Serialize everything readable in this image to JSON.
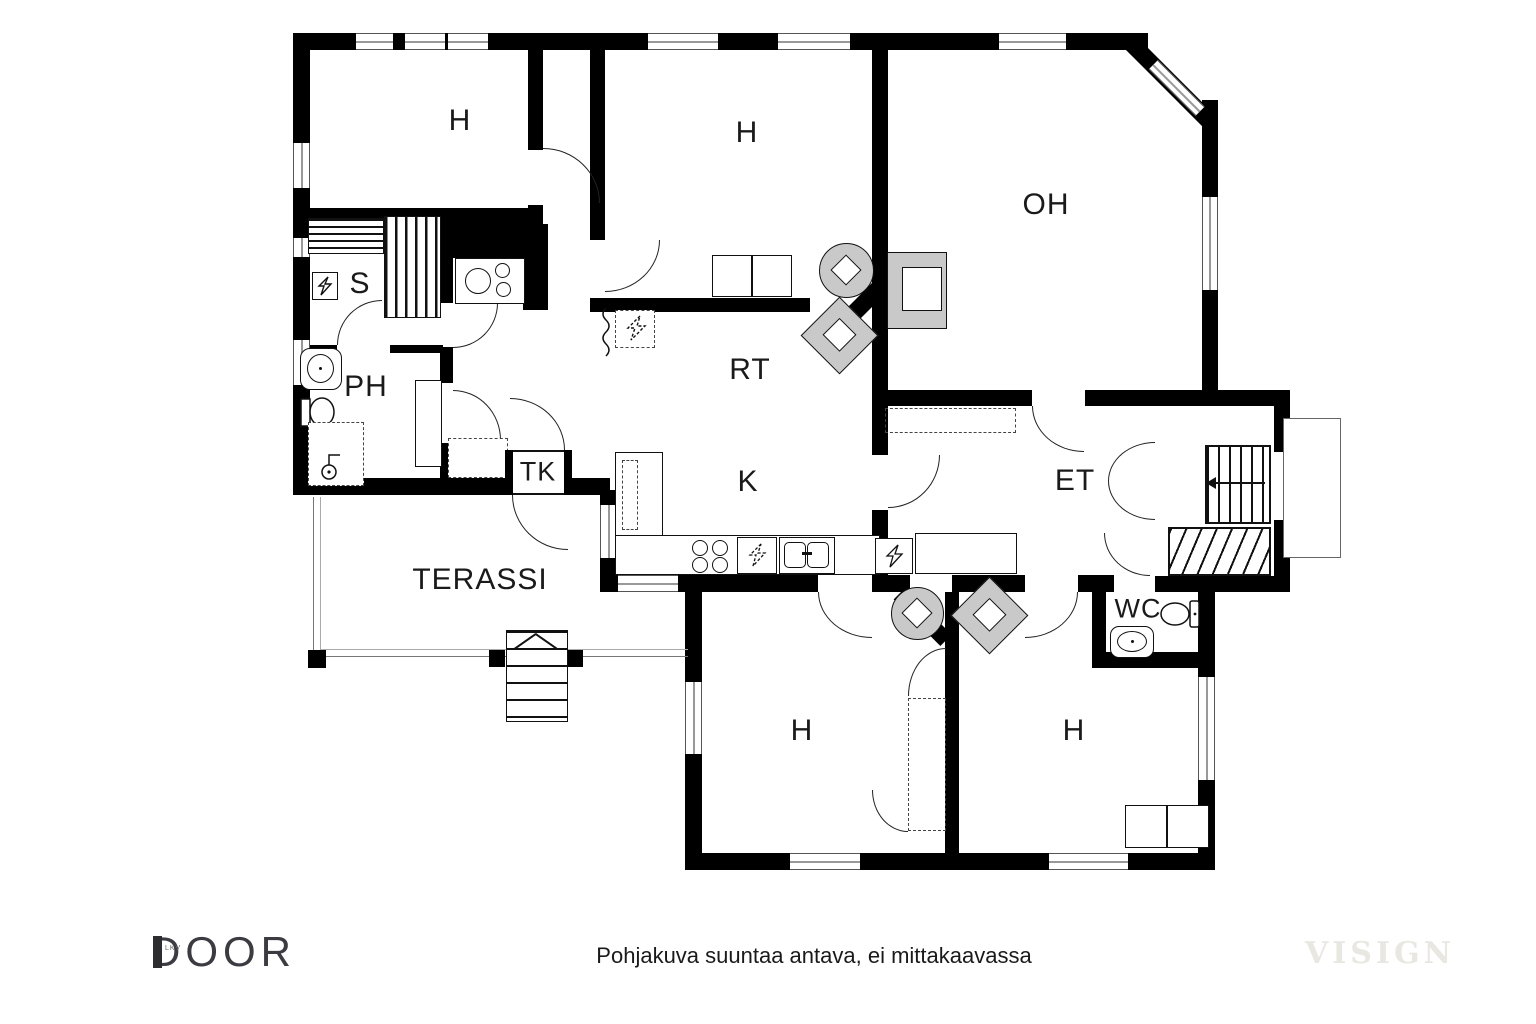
{
  "rooms": {
    "h1": "H",
    "h2": "H",
    "oh": "OH",
    "s": "S",
    "ph": "PH",
    "rt": "RT",
    "tk": "TK",
    "k": "K",
    "et": "ET",
    "wc": "WC",
    "h3": "H",
    "h4": "H",
    "terassi": "TERASSI"
  },
  "footer": {
    "brand": "DOOR",
    "brand_sub": "LKV",
    "disclaimer": "Pohjakuva suuntaa antava, ei mittakaavassa",
    "watermark": "VISIGN"
  },
  "colors": {
    "wall": "#000000",
    "furniture": "#c9c9c9",
    "text": "#1a1a1a",
    "watermark_text": "#e9e7e2"
  }
}
